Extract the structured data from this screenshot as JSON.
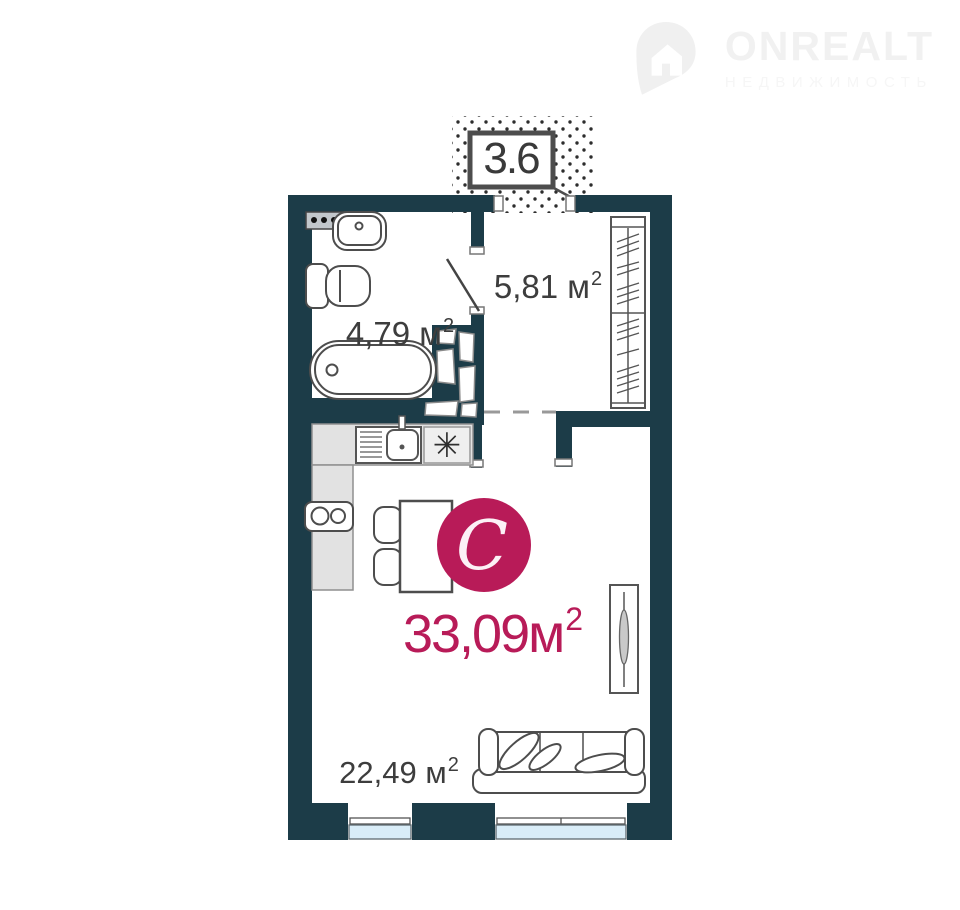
{
  "logo": {
    "brand": "ONREALT",
    "subtitle": "НЕДВИЖИМОСТЬ"
  },
  "floorplan": {
    "studio_letter": "С",
    "total_area": {
      "text": "33,09м",
      "sup": "2"
    },
    "balcony_area": "3.6",
    "rooms": [
      {
        "id": "bathroom",
        "area": {
          "text": "4,79 м",
          "sup": "2"
        }
      },
      {
        "id": "hallway",
        "area": {
          "text": "5,81 м",
          "sup": "2"
        }
      },
      {
        "id": "living",
        "area": {
          "text": "22,49 м",
          "sup": "2"
        }
      }
    ],
    "symbols": {
      "stove": "✳"
    },
    "colors": {
      "wall": "#1c3c48",
      "accent": "#b81b58",
      "label": "#3d3d3d",
      "window_glass": "#d9edf8",
      "counter": "#e2e2e2"
    }
  }
}
